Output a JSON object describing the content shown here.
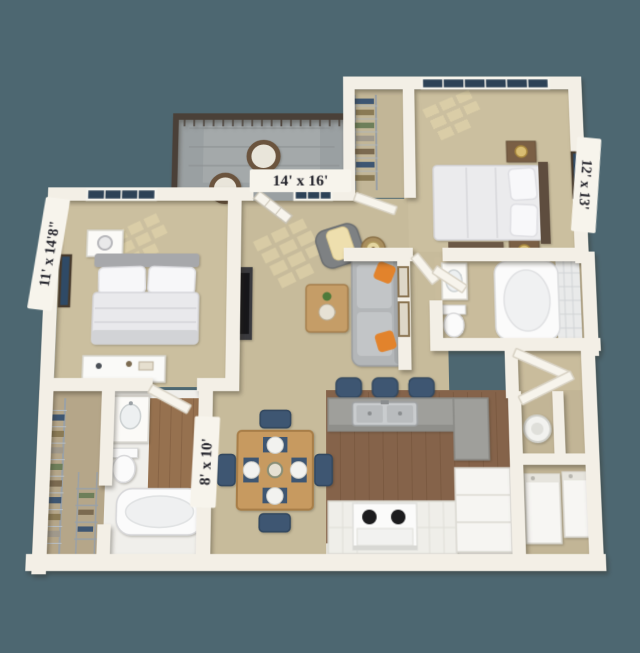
{
  "scene": {
    "type": "3d-floorplan-render",
    "description": "Top-down 3D rendered apartment floor plan, two bedrooms, two baths, balcony",
    "background_color": "#4d6771",
    "wall_color": "#f3efe6",
    "carpet_color": "#c9bd9d",
    "kitchen_wood_color": "#85634a",
    "tile_color": "#f0efeb",
    "accent_pillow_color": "#e2832c",
    "chair_navy_color": "#3e5672",
    "window_glass_color": "#2d4257",
    "balcony_floor_color": "#9aa0a2",
    "railing_color": "#4a4038"
  },
  "labels": {
    "living_room": "14' x 16'",
    "bedroom_right": "12' x 13'",
    "bedroom_left": "11' x 14'8\"",
    "bath_hall": "8' x 10'"
  },
  "rooms": [
    {
      "id": "balcony",
      "furniture": [
        "round-wicker-chair",
        "round-wicker-chair",
        "side-table",
        "railing"
      ]
    },
    {
      "id": "living-room",
      "label": "14' x 16'",
      "furniture": [
        "sofa",
        "orange-pillows",
        "armchair",
        "throw-blanket",
        "coffee-table",
        "side-table-lamp",
        "tv",
        "french-doors",
        "wall-art"
      ]
    },
    {
      "id": "bedroom-left",
      "label": "11' x 14'8\"",
      "furniture": [
        "bed",
        "nightstand",
        "lamp",
        "dresser",
        "wall-art",
        "window"
      ]
    },
    {
      "id": "bedroom-right",
      "label": "12' x 13'",
      "furniture": [
        "bed",
        "nightstand",
        "nightstand",
        "gold-lamp",
        "bench",
        "wall-art",
        "window"
      ]
    },
    {
      "id": "walk-in-closet-top",
      "furniture": [
        "wire-shelving",
        "clothes"
      ]
    },
    {
      "id": "bathroom-right",
      "furniture": [
        "tub",
        "tile-surround",
        "toilet",
        "vanity-sink"
      ]
    },
    {
      "id": "linen-closet",
      "furniture": [
        "louvered-door"
      ]
    },
    {
      "id": "walk-in-closet-bottom",
      "furniture": [
        "wire-shelving",
        "clothes",
        "shoe-rack"
      ]
    },
    {
      "id": "bathroom-bottom",
      "label": "8' x 10'",
      "furniture": [
        "vanity-sink",
        "toilet",
        "garden-tub"
      ]
    },
    {
      "id": "dining",
      "furniture": [
        "square-table",
        "navy-chair",
        "navy-chair",
        "navy-chair",
        "navy-chair",
        "place-settings"
      ]
    },
    {
      "id": "kitchen",
      "furniture": [
        "breakfast-bar",
        "double-sink",
        "bar-stool",
        "bar-stool",
        "bar-stool",
        "range-stove",
        "counter",
        "fridge-cabinet"
      ]
    },
    {
      "id": "utility",
      "furniture": [
        "water-heater",
        "washer",
        "dryer",
        "louvered-door"
      ]
    }
  ]
}
